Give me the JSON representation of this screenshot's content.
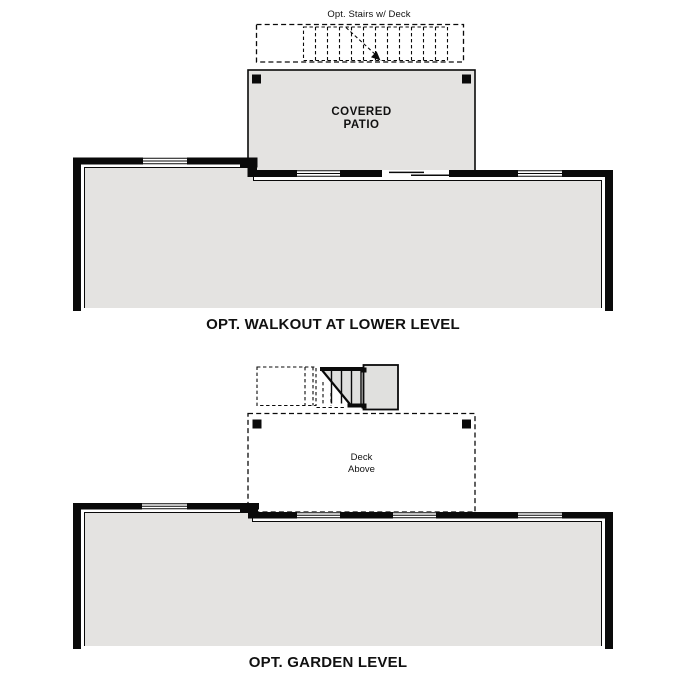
{
  "sheet": {
    "background": "#ffffff",
    "line_color": "#0a0a0a",
    "floor_fill": "#e4e3e1",
    "stair_landing_fill": "#e0e0de"
  },
  "walkout_plan": {
    "stairs_note": "Opt. Stairs w/ Deck",
    "patio_label": [
      "COVERED",
      "PATIO"
    ],
    "caption": "OPT. WALKOUT AT LOWER LEVEL"
  },
  "garden_plan": {
    "deck_label": [
      "Deck",
      "Above"
    ],
    "caption": "OPT. GARDEN LEVEL"
  }
}
